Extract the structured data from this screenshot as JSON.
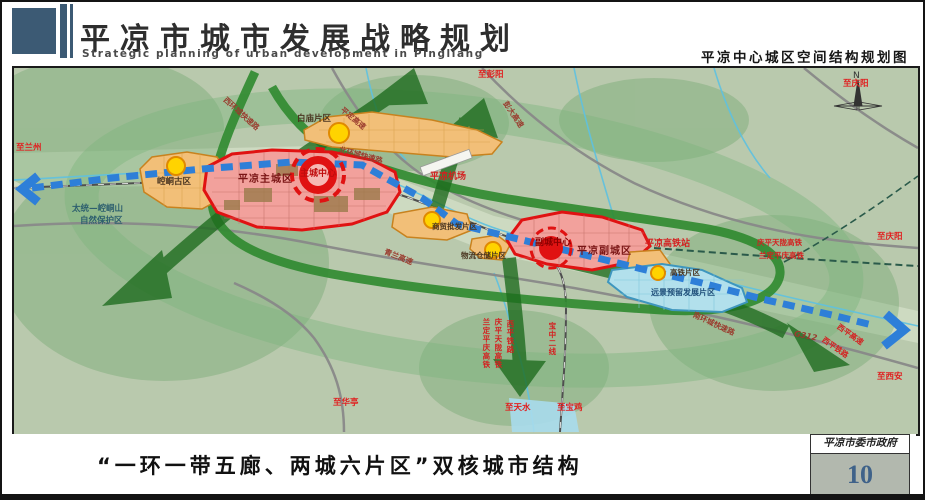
{
  "header": {
    "title": "平凉市城市发展战略规划",
    "subtitle": "Strategic planning of urban development in Pingliang",
    "map_title": "平凉中心城区空间结构规划图"
  },
  "footer": {
    "caption": "“一环一带五廊、两城六片区”双核城市结构",
    "agency": "平凉市委市政府",
    "page_number": "10"
  },
  "map": {
    "compass_label": "N",
    "districts": {
      "kongtong_old": "崆峒古区",
      "main_city": "平凉主城区",
      "main_center": "主城中心",
      "baimiao": "白庙片区",
      "trade_wholesale": "商贸批发片区",
      "logistics": "物流仓储片区",
      "sub_city": "平凉副城区",
      "sub_center": "副城中心",
      "hsr_zone": "高铁片区",
      "reserve_zone": "远景预留发展片区"
    },
    "places": {
      "airport": "平凉机场",
      "hsr_station": "平凉高铁站",
      "nature_reserve_line1": "太统—崆峒山",
      "nature_reserve_line2": "自然保护区"
    },
    "roads": {
      "west_ring": "西环城快速路",
      "north_ring": "北环城快速路",
      "south_ring": "南环城快速路",
      "pingding_expwy": "平定高速",
      "pengda_expwy": "彭大高速",
      "qinglan_expwy": "青兰高速",
      "g312": "G312",
      "xiping_expwy": "西平高速",
      "xiping_railway": "西平铁路",
      "qingping_tianlong_hsr": "庆平天陇高铁",
      "landing_pingqing_hsr": "兰定平庆高铁",
      "baozhong_line2": "宝中二线"
    },
    "directions": {
      "to_lanzhou": "至兰州",
      "to_pengyang": "至彭阳",
      "to_qingyang_top": "至庆阳",
      "to_qingyang_right": "至庆阳",
      "to_xian": "至西安",
      "to_huating": "至华亭",
      "to_tianshui": "至天水",
      "to_baoji": "至宝鸡"
    },
    "colors": {
      "urban_fill": "#f2a19c",
      "urban_border": "#e01212",
      "district_fill": "#f2bf78",
      "district_border": "#c8821e",
      "reserve_fill": "#b2e0ec",
      "corridor_green": "#1d6b1d",
      "belt_blue": "#2e7fd8",
      "node_yellow": "#ffd300"
    }
  }
}
